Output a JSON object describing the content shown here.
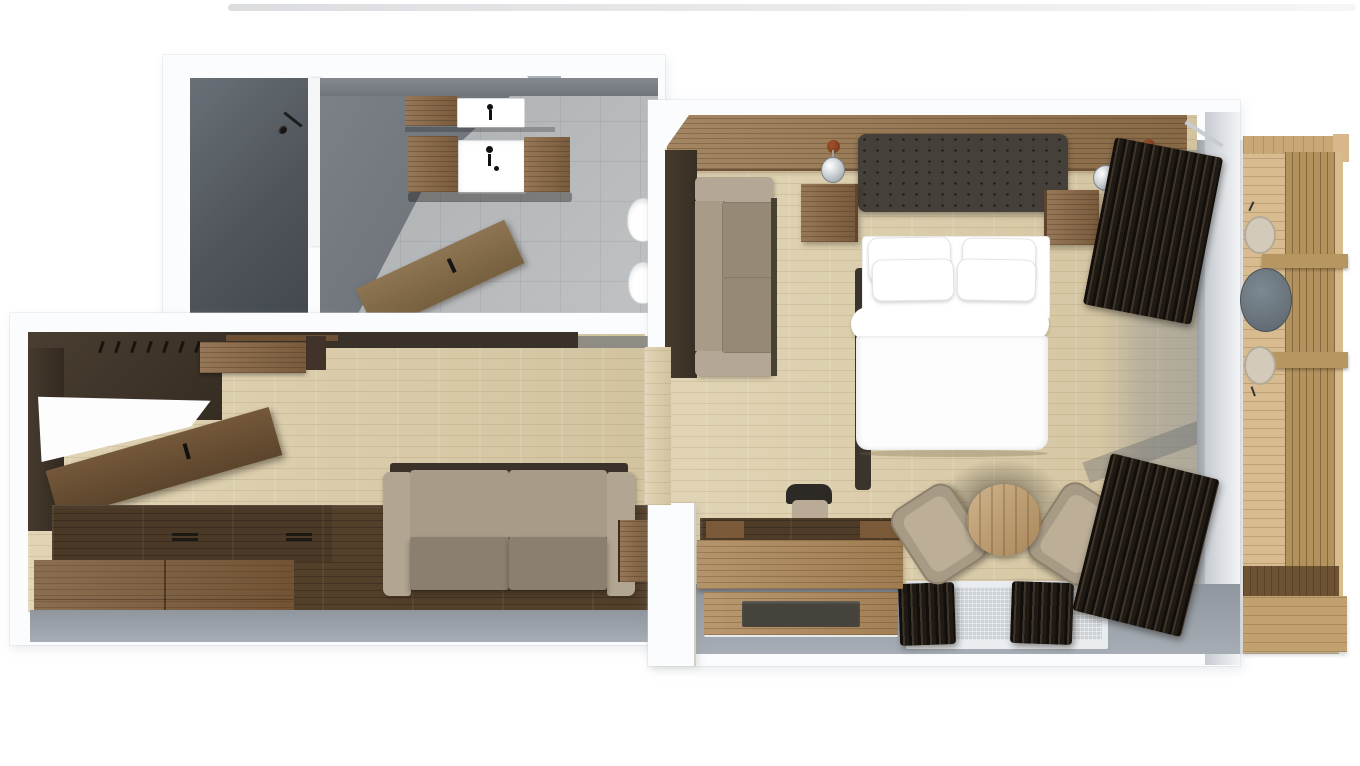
{
  "palette": {
    "background": "#ffffff",
    "wall_white": "#fbfcfd",
    "wall_edge": "#dfe3e7",
    "wall_gray": "#969da5",
    "wall_dark_brown": "#3e342a",
    "shower_gray": "#555b61",
    "tile_floor": "#b9bcbe",
    "wood_floor": "#ddcfab",
    "walnut": "#53402b",
    "oak": "#8a6845",
    "oak_light": "#ac8657",
    "fabric_beige": "#a89b87",
    "fabric_seat": "#8b7f6f",
    "bed_white": "#ffffff",
    "headboard_dark": "#46403a",
    "curtain_dark": "#262019",
    "deck_wood": "#d8bc90",
    "screen_wood": "#b3925e",
    "glass_gray": "#ccd2d6",
    "copper": "#8c4a23",
    "floor_gray": "#99a0a8"
  },
  "labels": {
    "floorplan": "3D top-view floor plan of a hotel suite",
    "bathroom": "Bathroom",
    "shower": "Walk-in shower",
    "shower_head": "Shower head",
    "partition": "Shower partition wall",
    "vanity": "Wooden vanity with washbasin",
    "sink": "Washbasin",
    "toilet": "Toilet",
    "bidet": "Bidet",
    "bathroom_door": "Open bathroom door",
    "entry": "Entry and wardrobe area",
    "coat_hooks": "Coat rack hooks",
    "wall_cabinet": "Wall cabinet",
    "entry_door": "Open entrance door",
    "door_opening": "Door opening",
    "storage_bench": "Wooden storage bench with drawers",
    "platform": "Dark wood platform",
    "sofa": "Two-seat upholstered sofa",
    "side_table": "Wooden side table",
    "corridor": "Corridor with wood flooring",
    "bedroom": "Bedroom and living area",
    "headboard_wall": "Wooden headboard panel wall",
    "ceiling_spot": "Copper ceiling spot",
    "pendant_lamp": "Pendant lamp",
    "headboard": "Tufted headboard",
    "nightstand": "Wooden nightstand",
    "bed": "Double bed with white linens",
    "pillow": "Pillow",
    "duvet": "Duvet",
    "bedroom_sofa": "Sofa along bedroom wall",
    "curtain": "Dark curtain",
    "glass_wall": "Glass wall to balcony",
    "desk": "Wooden desk",
    "desk_chair": "Desk chair",
    "desk_tray": "Wooden desk tray",
    "luggage_rack": "Wooden luggage rack",
    "dark_mat": "Dark mat",
    "armchair": "Lounge armchair",
    "coffee_table": "Round wooden coffee table",
    "window": "Window with dark side curtains",
    "balcony": "Balcony",
    "deck": "Wooden balcony deck",
    "railing_screen": "Wooden slat privacy railing",
    "crossbeam": "Railing crossbeam",
    "stool": "Balcony stool",
    "bistro_table": "Round balcony table",
    "wall": "Wall"
  }
}
